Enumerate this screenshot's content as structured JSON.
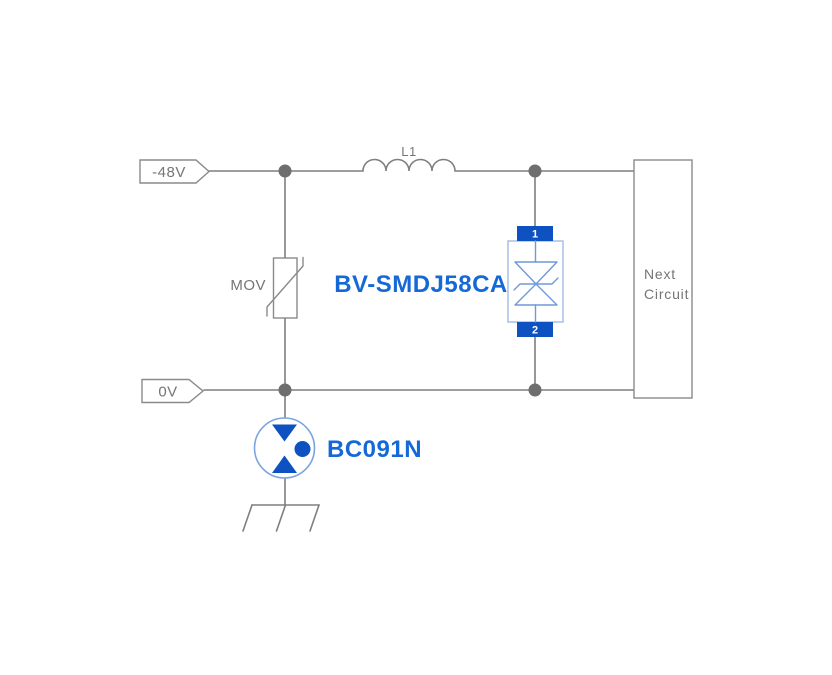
{
  "diagram": {
    "kind": "surge-protection-circuit-schematic",
    "background": "#ffffff",
    "colors": {
      "wire": "#7f7f7f",
      "junction": "#6e6e6e",
      "outline": "#8a8a8a",
      "deep_blue": "#0e52c2",
      "light_blue": "#a6c0e8",
      "mid_blue": "#6f99d9",
      "circle_blue": "#79a3e2",
      "label_blue": "#1569d7",
      "text_gray": "#757575"
    },
    "nets": [
      {
        "kind": "input-net-flag",
        "label": "-48V"
      },
      {
        "kind": "input-net-flag",
        "label": "0V"
      }
    ],
    "components": [
      {
        "kind": "inductor",
        "label": "L1"
      },
      {
        "kind": "metal-oxide-varistor",
        "label": "MOV"
      },
      {
        "kind": "bidirectional-tvs-diode",
        "label": "BV-SMDJ58CA",
        "pin_top": "1",
        "pin_bottom": "2"
      },
      {
        "kind": "surge-arrester",
        "label": "BC091N"
      },
      {
        "kind": "subsystem-block",
        "label_line1": "Next",
        "label_line2": "Circuit"
      }
    ]
  }
}
